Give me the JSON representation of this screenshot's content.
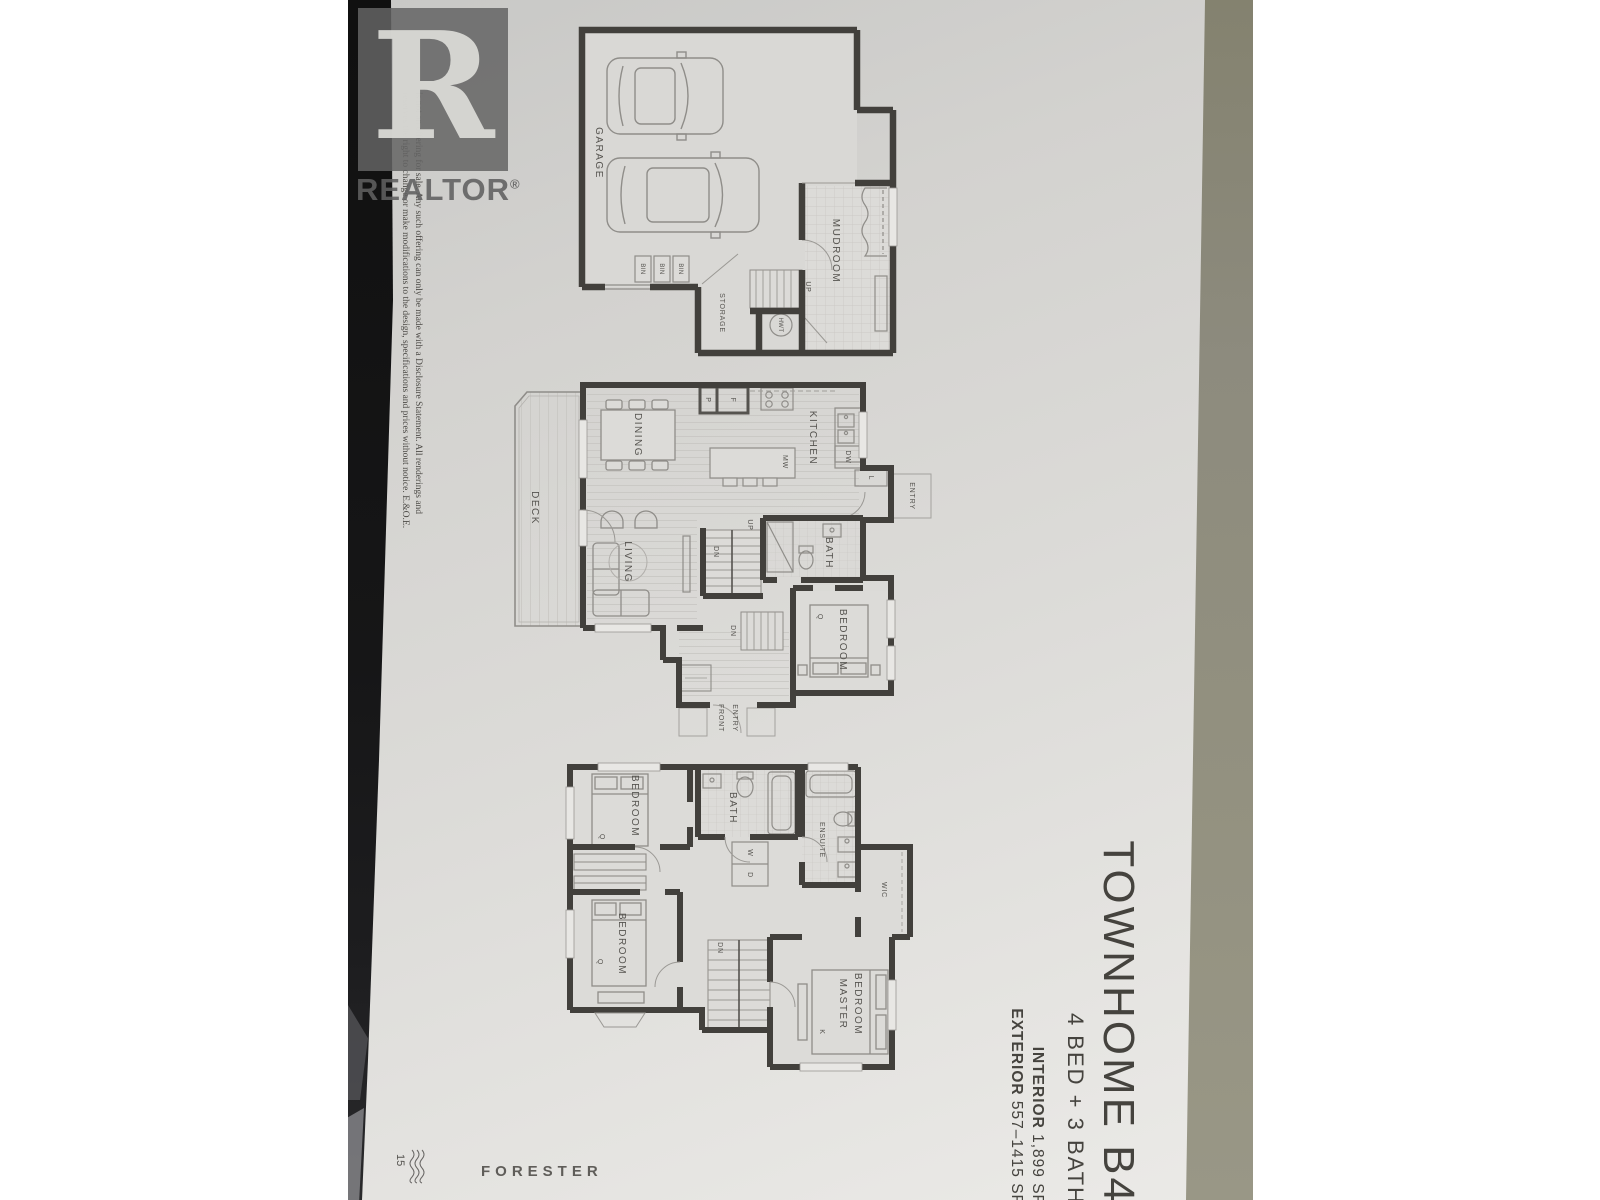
{
  "photo": {
    "watermark": {
      "logo_letter": "R",
      "brand": "REALTOR",
      "registered": "®"
    },
    "disclaimer": {
      "line1": "is not an offering for sale. Any such offering can only be made with a Disclosure Statement. All renderings and",
      "line2": "reserves the right to change or make modifications to the design, specifications and prices without notice. E.&O.E."
    },
    "title_block": {
      "plan_name": "TOWNHOME B4",
      "configuration": "4 BED + 3 BATH",
      "interior_label": "INTERIOR",
      "interior_area": "1,899 SF",
      "exterior_label": "EXTERIOR",
      "exterior_area": "557–1415 SF"
    },
    "brand_footer": "FORESTER",
    "page_number": "15",
    "floors": {
      "garage_level": {
        "garage": "GARAGE",
        "storage": "STORAGE",
        "mudroom": "MUDROOM",
        "up": "UP",
        "hwt": "HWT",
        "bin1": "BIN",
        "bin2": "BIN",
        "bin3": "BIN"
      },
      "main_level": {
        "deck": "DECK",
        "dining": "DINING",
        "kitchen": "KITCHEN",
        "pantry": "P",
        "fridge": "F",
        "microwave": "MW",
        "dishwasher": "DW",
        "linen": "L",
        "entry": "ENTRY",
        "up": "UP",
        "dn_upper": "DN",
        "dn_lower": "DN",
        "living": "LIVING",
        "bath": "BATH",
        "bedroom": "BEDROOM",
        "bed_size": "Q",
        "front_entry_line1": "FRONT",
        "front_entry_line2": "ENTRY"
      },
      "upper_level": {
        "bedroom_top": "BEDROOM",
        "bed_top_size": "Q",
        "bath": "BATH",
        "washer": "W",
        "dryer": "D",
        "ensuite": "ENSUITE",
        "wic": "WIC",
        "bedroom_bottom": "BEDROOM",
        "bed_bottom_size": "Q",
        "dn": "DN",
        "master_line1": "MASTER",
        "master_line2": "BEDROOM",
        "master_bed_size": "K"
      }
    },
    "colors": {
      "paper": "#dcdbd8",
      "walls": "#42403c",
      "floor_beyond_paper": "#8d8b7e",
      "dark_edge": "#161617",
      "watermark_gray": "#646464"
    }
  }
}
